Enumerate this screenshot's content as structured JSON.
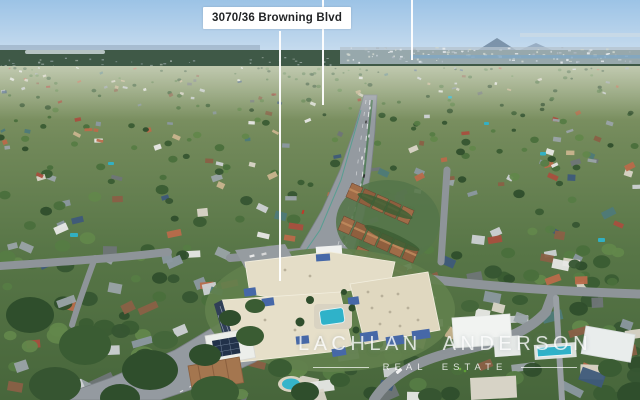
{
  "overlay": {
    "address_label": "3070/36 Browning Blvd",
    "watermark": {
      "line1": "LACHLAN ANDERSON",
      "line2": "REAL ESTATE"
    }
  },
  "palette": {
    "label_bg": "#ffffff",
    "label_text": "#222426",
    "pointer_line": "#ffffff",
    "watermark_text": "#ffffff",
    "sky_top": "#9cc3e6",
    "sky_horizon": "#d2e2f0",
    "far_ridge": "#8ba0b4",
    "forest_band": "#3f5947",
    "water_strip": "#7fa6c4",
    "land_far": "#8d9d6e",
    "land_near": "#47663b",
    "highway": "#949aa0",
    "local_street": "#8e9499",
    "pool": "#2fb2c9",
    "apartment_roof": "#e4ddc7",
    "apartment_wall_shadow": "#303f57",
    "awning_blue": "#4668a8",
    "townhouse_roof": "#a06c48",
    "solar_panel": "#22324a",
    "red_car": "#c0392b",
    "city_speckles": [
      "#dfe5ea",
      "#c2ccd4",
      "#aeb9c2",
      "#e8ecef",
      "#cfd6cf"
    ],
    "tree_colors": [
      "#3a5c33",
      "#4a6f3c",
      "#567c44",
      "#2f4e2c",
      "#62874b",
      "#365531"
    ],
    "roof_colors": [
      "#e8e8e6",
      "#cdd1d4",
      "#b96a4a",
      "#6f7577",
      "#c9b48e",
      "#a84f3e",
      "#9aa3a8",
      "#dad5c8",
      "#8b98a0",
      "#3e5a7a",
      "#4e7a78",
      "#8a6046"
    ]
  }
}
